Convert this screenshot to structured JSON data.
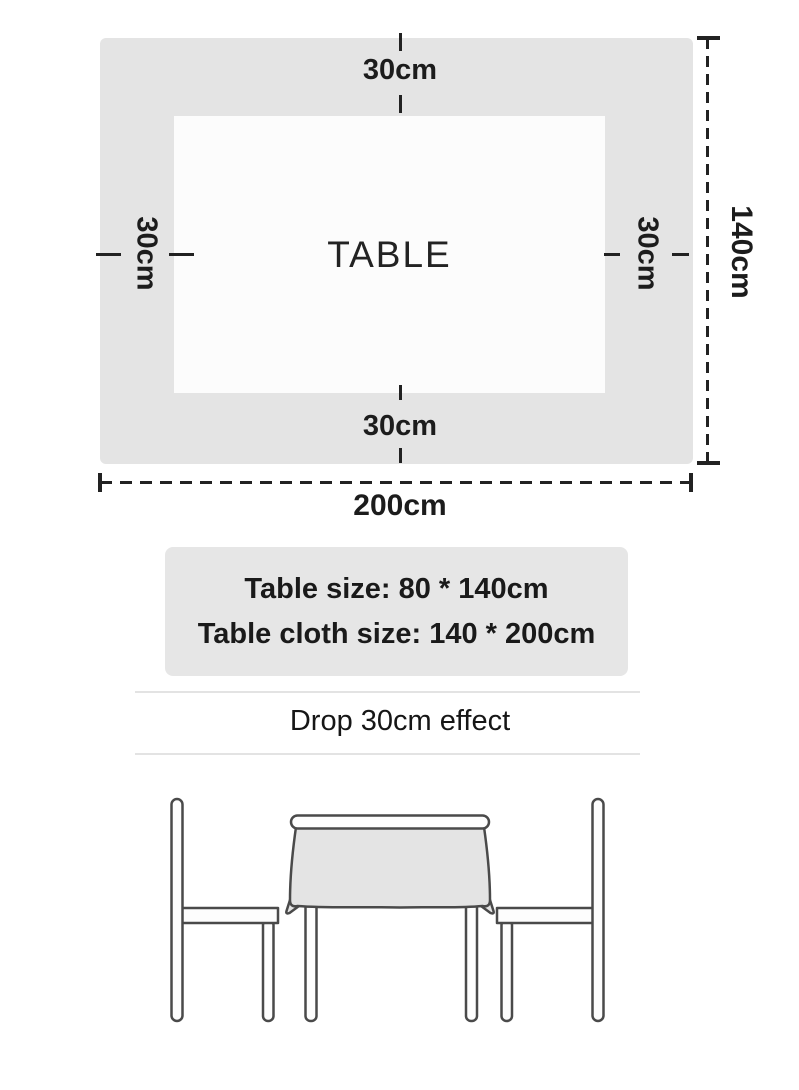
{
  "diagram": {
    "table_label": "TABLE",
    "drop_top": "30cm",
    "drop_bottom": "30cm",
    "drop_left": "30cm",
    "drop_right": "30cm",
    "height_label": "140cm",
    "width_label": "200cm"
  },
  "info_box": {
    "table_size_line": "Table size: 80 * 140cm",
    "cloth_size_line": "Table cloth size: 140 * 200cm"
  },
  "drop_banner": {
    "text": "Drop 30cm effect"
  },
  "colors": {
    "cloth_gray": "#e4e4e4",
    "info_box_gray": "#e6e6e6",
    "dimension_line": "#222222",
    "illustration_outline": "#4a4a4a",
    "text": "#1c1c1c"
  }
}
